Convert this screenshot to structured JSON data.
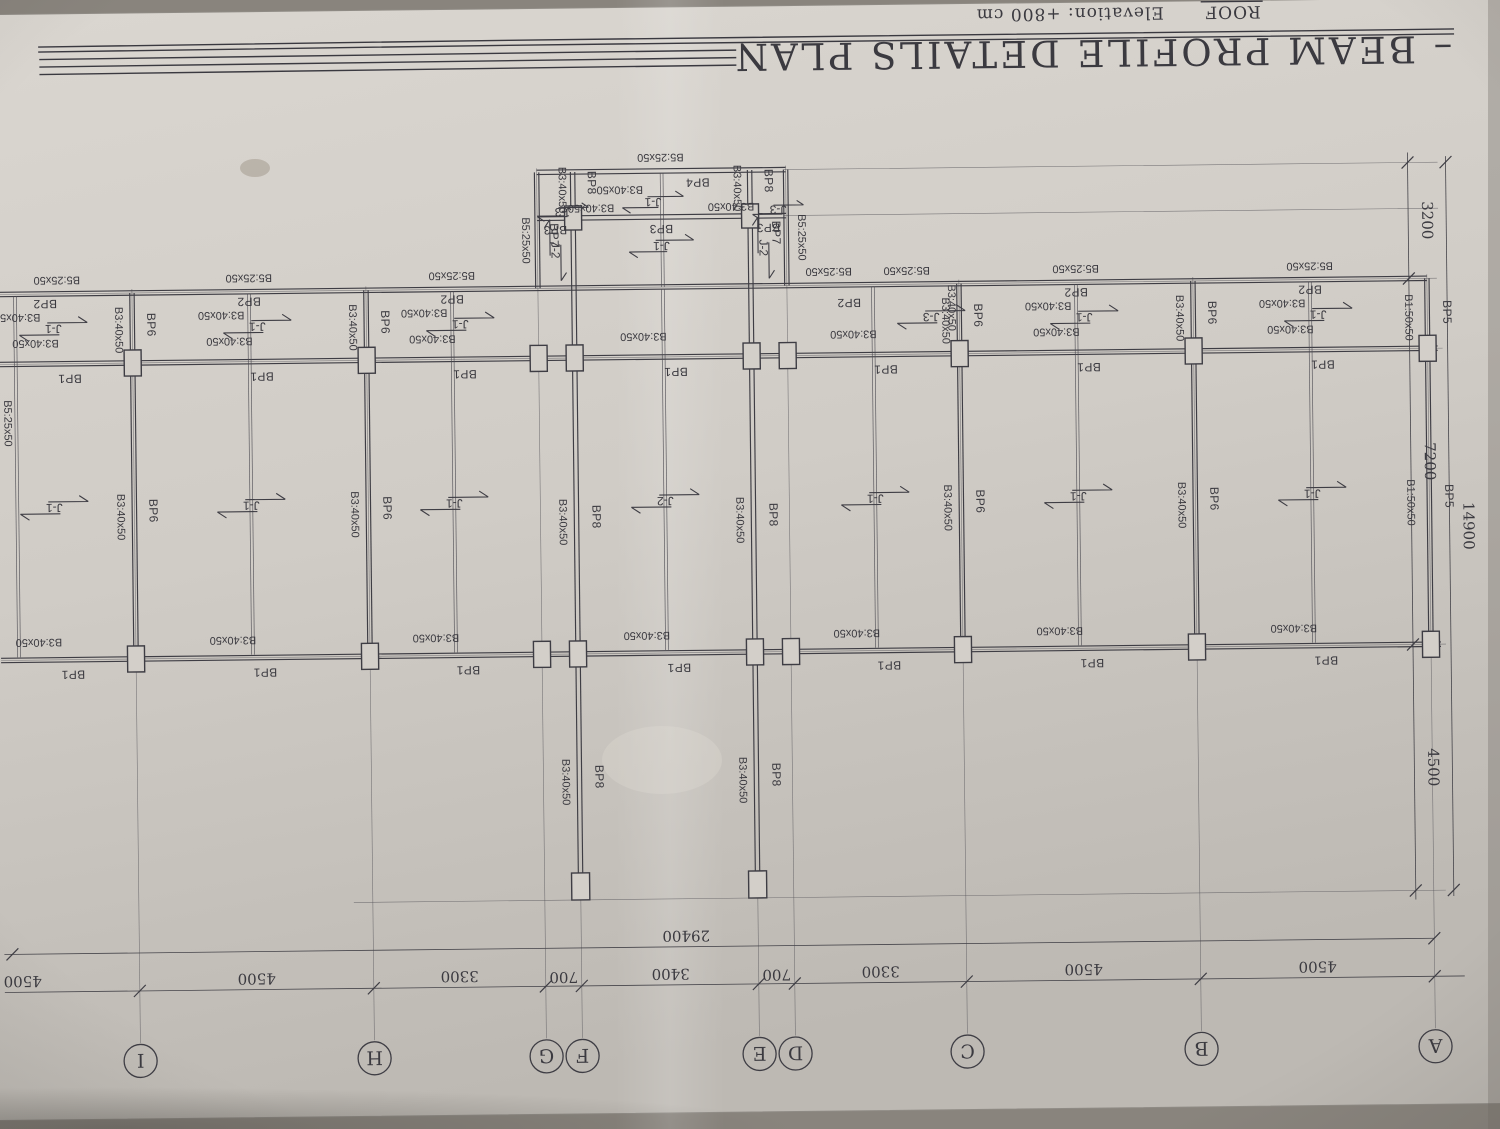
{
  "sheet": {
    "title": "– BEAM PROFILE DETAILS PLAN",
    "roof_label": "ROOF",
    "elevation_label": "Elevation: +800 cm"
  },
  "grid": {
    "letters": [
      "A",
      "B",
      "C",
      "D",
      "E",
      "F",
      "G",
      "H",
      "I"
    ],
    "bay_dims": [
      "4500",
      "4500",
      "3300",
      "700",
      "3400",
      "700",
      "3300",
      "4500",
      "4500"
    ],
    "total_width": "29400",
    "side_dims": [
      "4500",
      "7200",
      "3200"
    ],
    "total_depth": "14900"
  },
  "beams": {
    "bp1": "BP1",
    "bp2": "BP2",
    "bp3": "BP3",
    "bp4": "BP4",
    "bp5": "BP5",
    "bp6": "BP6",
    "bp7": "BP7",
    "bp8": "BP8"
  },
  "sizes": {
    "b1": "B1:50x50",
    "b3": "B3:40x50",
    "b5": "B5:25x50"
  },
  "sections": {
    "j1": "J-1",
    "j2": "J-2",
    "j3": "J-3"
  }
}
